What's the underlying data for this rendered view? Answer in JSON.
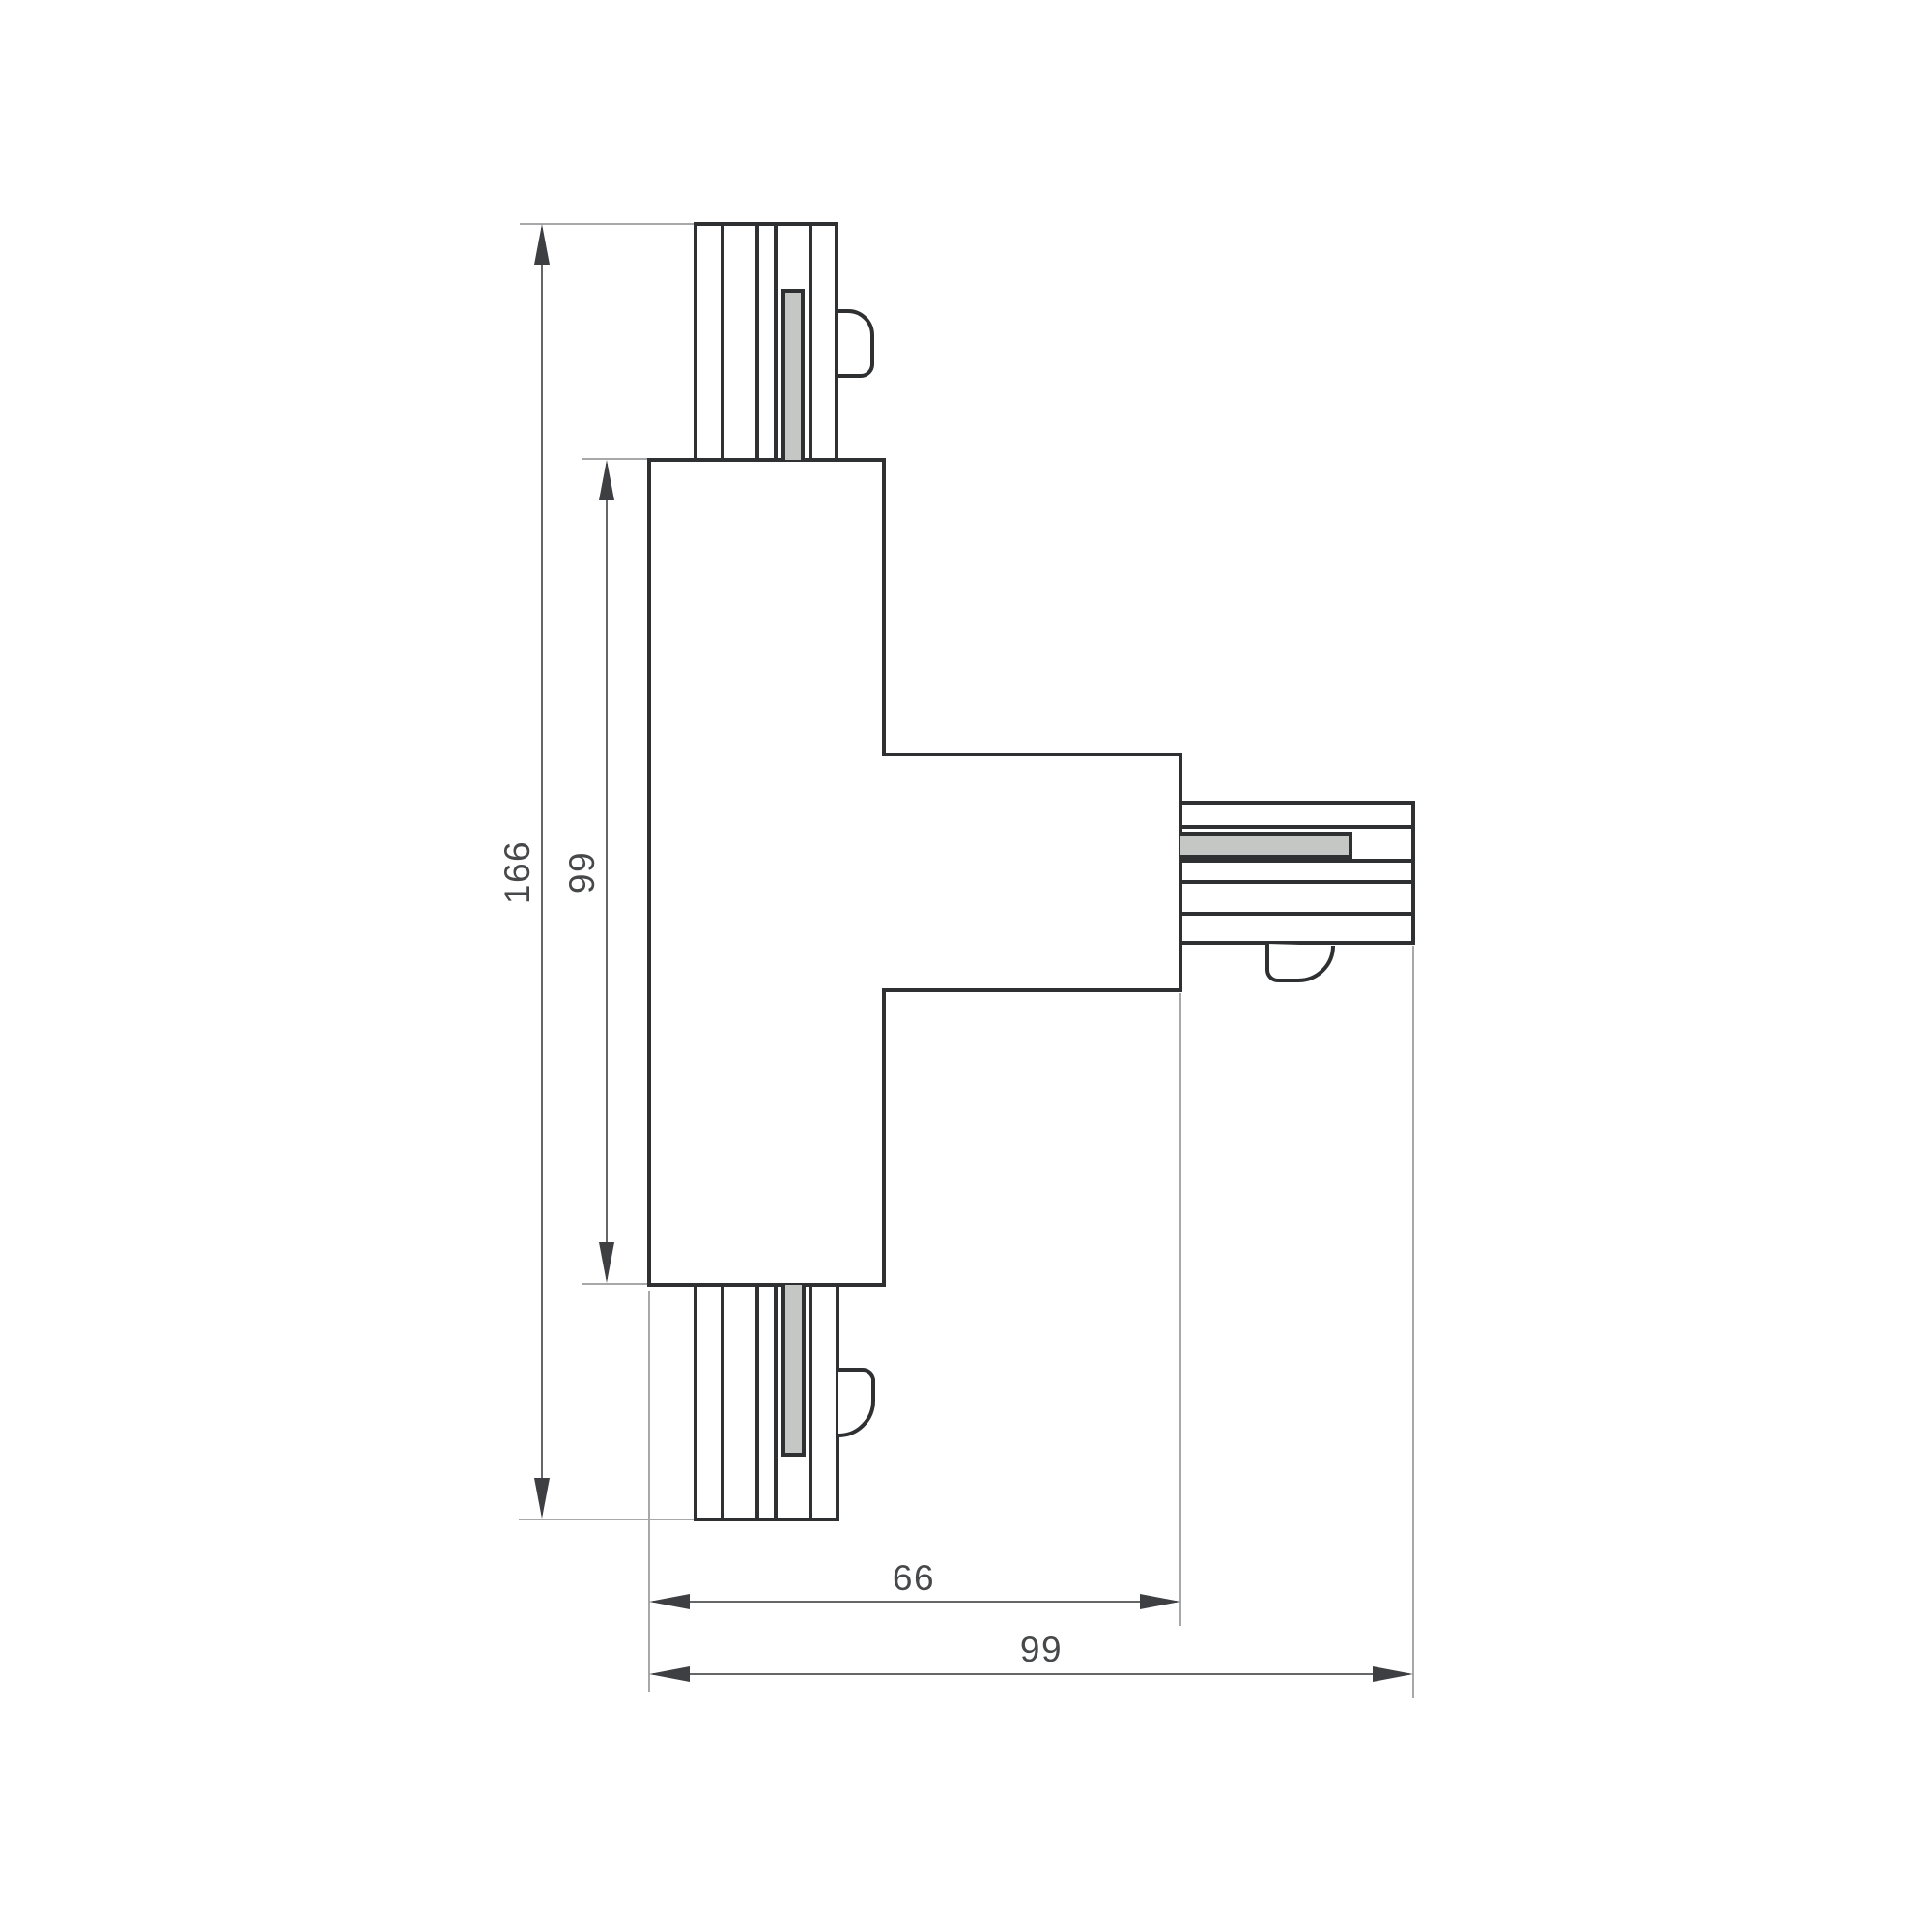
{
  "drawing": {
    "dimension_labels": {
      "overall_height": "166",
      "body_height": "99",
      "branch_width": "66",
      "overall_width": "99"
    },
    "colors": {
      "outline": "#2e3032",
      "contact_strip_fill": "#c5c7c5",
      "dimension_line": "#646668",
      "extension_line": "#a6a8a9",
      "arrow": "#3d3f42",
      "label_text": "#46484a",
      "background": "#ffffff"
    }
  }
}
